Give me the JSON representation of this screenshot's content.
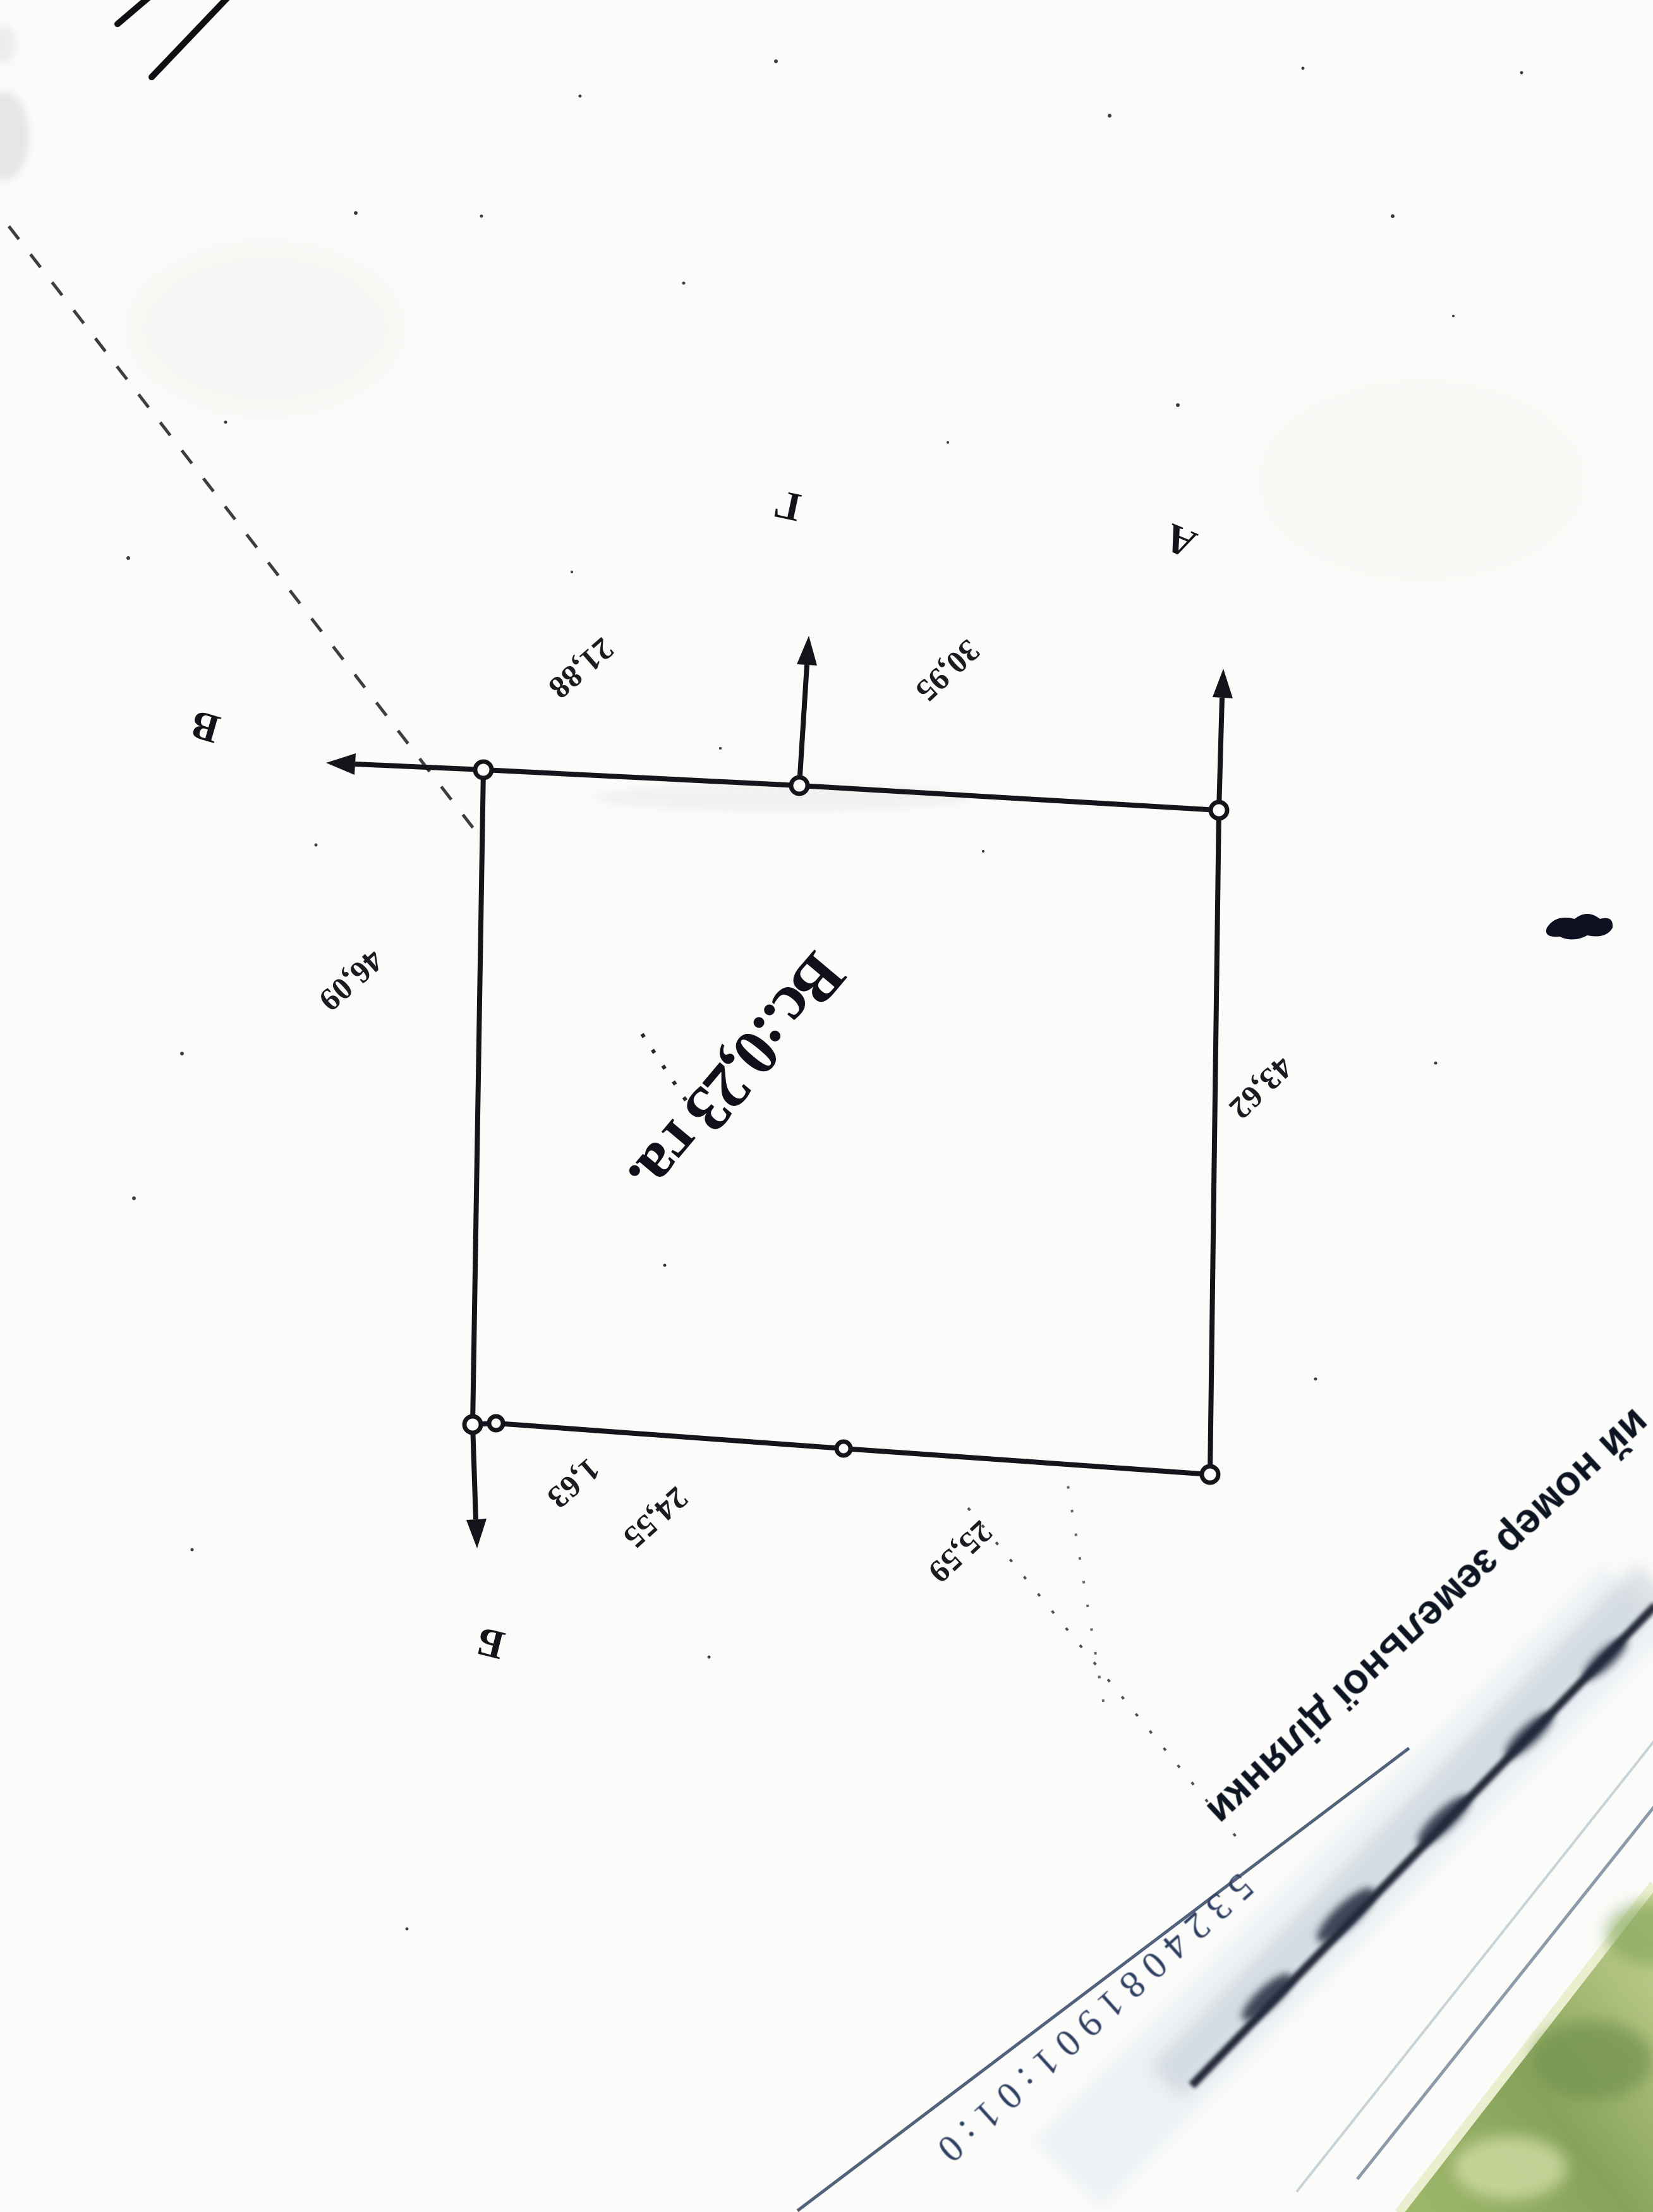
{
  "plan": {
    "area_label": "Вс.:0,23 га.",
    "vertices": [
      {
        "id": "A",
        "label": "А"
      },
      {
        "id": "B",
        "label": "Б"
      },
      {
        "id": "V",
        "label": "В"
      },
      {
        "id": "G",
        "label": "Г"
      }
    ],
    "measurements": [
      {
        "edge": "top-segment-left",
        "value": "21,88"
      },
      {
        "edge": "top-segment-right",
        "value": "30,95"
      },
      {
        "edge": "left-side",
        "value": "46,09"
      },
      {
        "edge": "right-side",
        "value": "43,62"
      },
      {
        "edge": "bottom-tiny-segment",
        "value": "1,63"
      },
      {
        "edge": "bottom-segment-left",
        "value": "24,55"
      },
      {
        "edge": "bottom-segment-right",
        "value": "25,59"
      }
    ]
  },
  "footer": {
    "caption_fragment": "ий номер земельної ділянки",
    "cadastral_number": "5324081901:01:0"
  },
  "colors": {
    "ink": "#14141a",
    "number_ink": "#2e3e60",
    "paper": "#fbfbf9",
    "corner_green": "#8aa75e"
  }
}
